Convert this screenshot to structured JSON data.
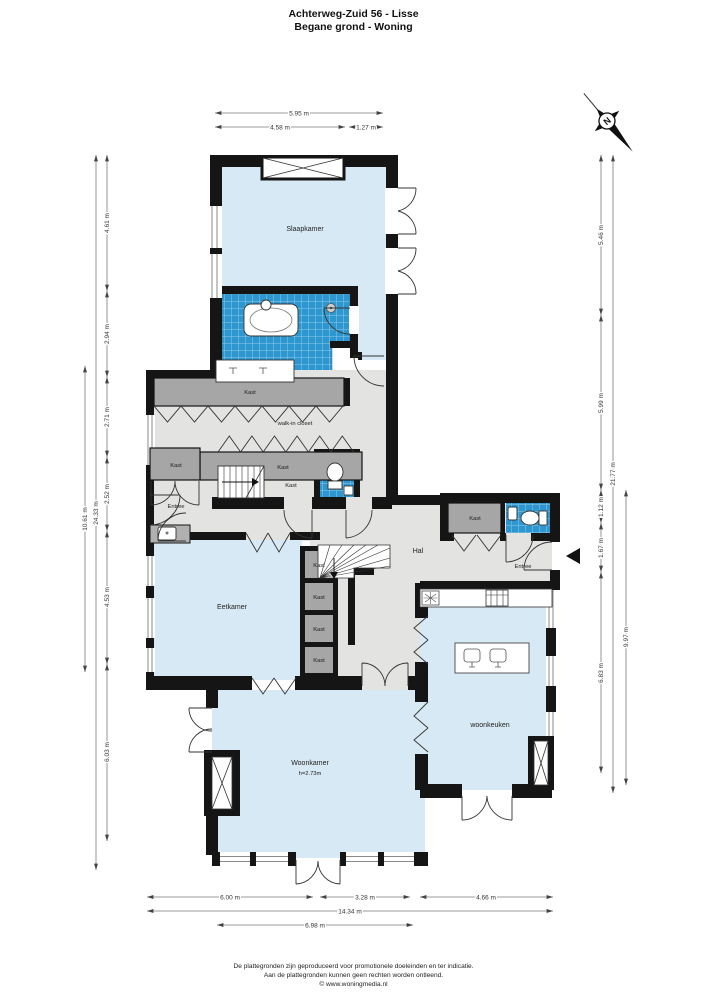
{
  "title": {
    "line1": "Achterweg-Zuid 56 - Lisse",
    "line2": "Begane grond - Woning"
  },
  "compass": {
    "north_label": "N"
  },
  "labels": {
    "slaapkamer": "Slaapkamer",
    "kast": "Kast",
    "walk_in_closet": "walk-in closet",
    "entree": "Entree",
    "eetkamer": "Eetkamer",
    "hal": "Hal",
    "woonkeuken": "woonkeuken",
    "woonkamer": "Woonkamer",
    "woonkamer_height": "h=2.73m"
  },
  "dimensions": {
    "top": [
      "5.95 m",
      "4.58 m",
      "1.27 m"
    ],
    "bottom": [
      "6.00 m",
      "3.28 m",
      "4.66 m"
    ],
    "bottom_total": "14.34 m",
    "bottom_partial": "6.98 m",
    "left_segments": [
      "4.61 m",
      "2.94 m",
      "2.71 m",
      "2.52 m",
      "4.53 m",
      "6.03 m"
    ],
    "left_total": "24.33 m",
    "left_partial": "10.61 m",
    "right_segments": [
      "5.46 m",
      "5.99 m",
      "1.12 m",
      "1.67 m",
      "6.83 m"
    ],
    "right_total": "21.77 m",
    "right_partial": "9.97 m"
  },
  "footer": {
    "line1": "De plattegronden zijn geproduceerd voor promotionele doeleinden en ter indicatie.",
    "line2": "Aan de plattegronden kunnen geen rechten worden ontleend.",
    "line3": "© www.woningmedia.nl"
  },
  "colors": {
    "room_fill": "#d7e9f4",
    "tile_fill": "#2e97cf",
    "closet_fill": "#a6a6a6",
    "floor_fill": "#e3e3e1",
    "wall": "#151515"
  }
}
